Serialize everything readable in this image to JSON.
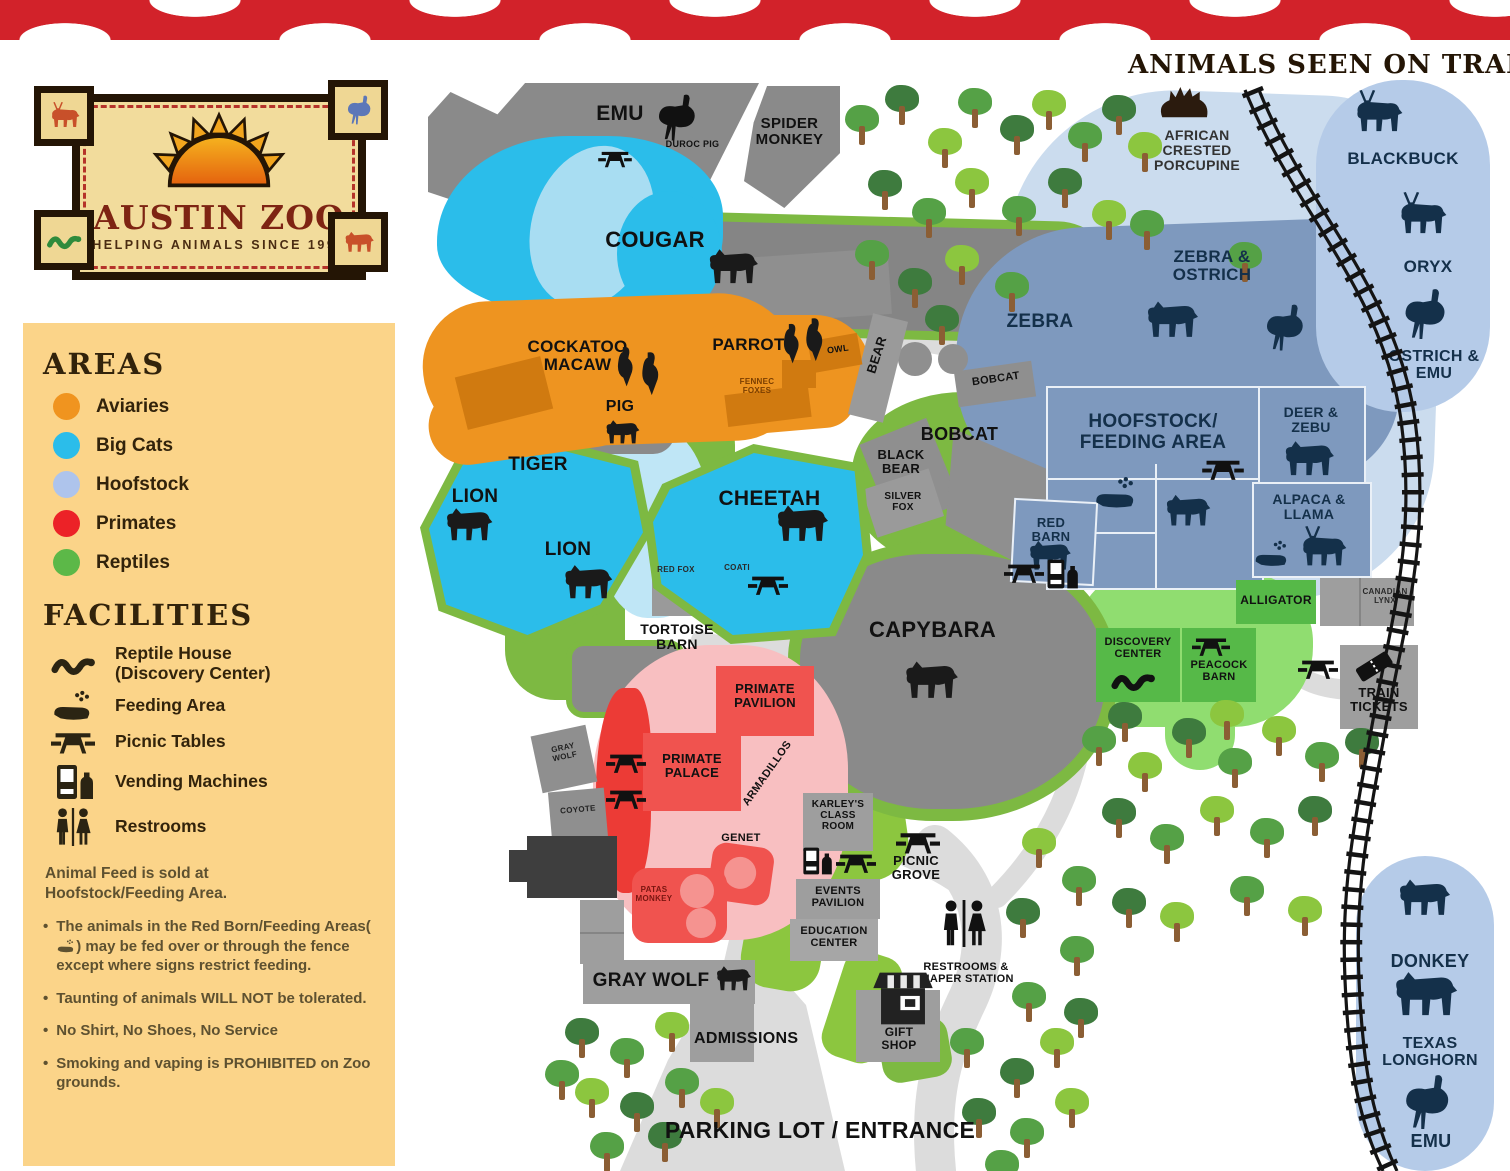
{
  "logo": {
    "title": "AUSTIN ZOO",
    "subtitle": "HELPING ANIMALS SINCE 1990"
  },
  "train_header": "ANIMALS SEEN ON TRAIN:",
  "legend": {
    "areas_title": "AREAS",
    "areas": [
      {
        "label": "Aviaries",
        "color": "#F0941F"
      },
      {
        "label": "Big Cats",
        "color": "#2BBDEA"
      },
      {
        "label": "Hoofstock",
        "color": "#AEC4EC"
      },
      {
        "label": "Primates",
        "color": "#EC2227"
      },
      {
        "label": "Reptiles",
        "color": "#5CB848"
      }
    ],
    "facilities_title": "FACILITIES",
    "facilities": [
      {
        "icon": "snake-icon",
        "label": "Reptile House (Discovery Center)"
      },
      {
        "icon": "feeding-icon",
        "label": "Feeding Area"
      },
      {
        "icon": "picnic-table-icon",
        "label": "Picnic Tables"
      },
      {
        "icon": "vending-machine-icon",
        "label": "Vending Machines"
      },
      {
        "icon": "restrooms-icon",
        "label": "Restrooms"
      }
    ],
    "note": "Animal Feed is sold at Hoofstock/Feeding Area.",
    "bullet1_before": "The animals in the Red Born/Feeding Areas(",
    "bullet1_after": ") may be fed over or through the fence except where signs restrict feeding.",
    "bullet2": "Taunting of animals WILL NOT be tolerated.",
    "bullet3": "No Shirt, No Shoes, No Service",
    "bullet4": "Smoking and vaping is PROHIBITED on Zoo grounds."
  },
  "map": {
    "emu": "EMU",
    "duroc_pig": "DUROC PIG",
    "spider_monkey": "SPIDER MONKEY",
    "cougar": "COUGAR",
    "cockatoo_macaw": "COCKATOO MACAW",
    "parrot": "PARROT",
    "owl": "OWL",
    "fennec_foxes": "FENNEC FOXES",
    "pig": "PIG",
    "tiger": "TIGER",
    "lion_upper": "LION",
    "lion_lower": "LION",
    "cheetah": "CHEETAH",
    "bear": "BEAR",
    "bobcat_upper": "BOBCAT",
    "bobcat": "BOBCAT",
    "black_bear": "BLACK BEAR",
    "silver_fox": "SILVER FOX",
    "zebra": "ZEBRA",
    "zebra_ostrich": "ZEBRA & OSTRICH",
    "african_crested_porcupine": "AFRICAN CRESTED PORCUPINE",
    "blackbuck": "BLACKBUCK",
    "oryx": "ORYX",
    "ostrich_emu": "OSTRICH & EMU",
    "hoofstock_feeding_area": "HOOFSTOCK/ FEEDING AREA",
    "deer_zebu": "DEER & ZEBU",
    "alpaca_llama": "ALPACA & LLAMA",
    "red_barn": "RED BARN",
    "capybara": "CAPYBARA",
    "tortoise_barn": "TORTOISE BARN",
    "red_fox": "RED FOX",
    "coati": "COATI",
    "alligator": "ALLIGATOR",
    "canadian_lynx": "CANADIAN LYNX",
    "discovery_center": "DISCOVERY CENTER",
    "peacock_barn": "PEACOCK BARN",
    "train_tickets": "TRAIN TICKETS",
    "primate_pavilion": "PRIMATE PAVILION",
    "primate_palace": "PRIMATE PALACE",
    "armadillos": "ARMADILLOS",
    "genet": "GENET",
    "patas_monkey": "PATAS MONKEY",
    "gray_wolf_pen": "GRAY WOLF",
    "coyote": "COYOTE",
    "gray_wolf": "GRAY WOLF",
    "karleys_class_room": "KARLEY'S CLASS ROOM",
    "events_pavilion": "EVENTS PAVILION",
    "education_center": "EDUCATION CENTER",
    "picnic_grove": "PICNIC GROVE",
    "restrooms_diaper": "RESTROOMS & DIAPER STATION",
    "gift_shop": "GIFT SHOP",
    "admissions": "ADMISSIONS",
    "parking": "PARKING LOT / ENTRANCE",
    "donkey": "DONKEY",
    "texas_longhorn": "TEXAS LONGHORN",
    "emu_train": "EMU"
  }
}
